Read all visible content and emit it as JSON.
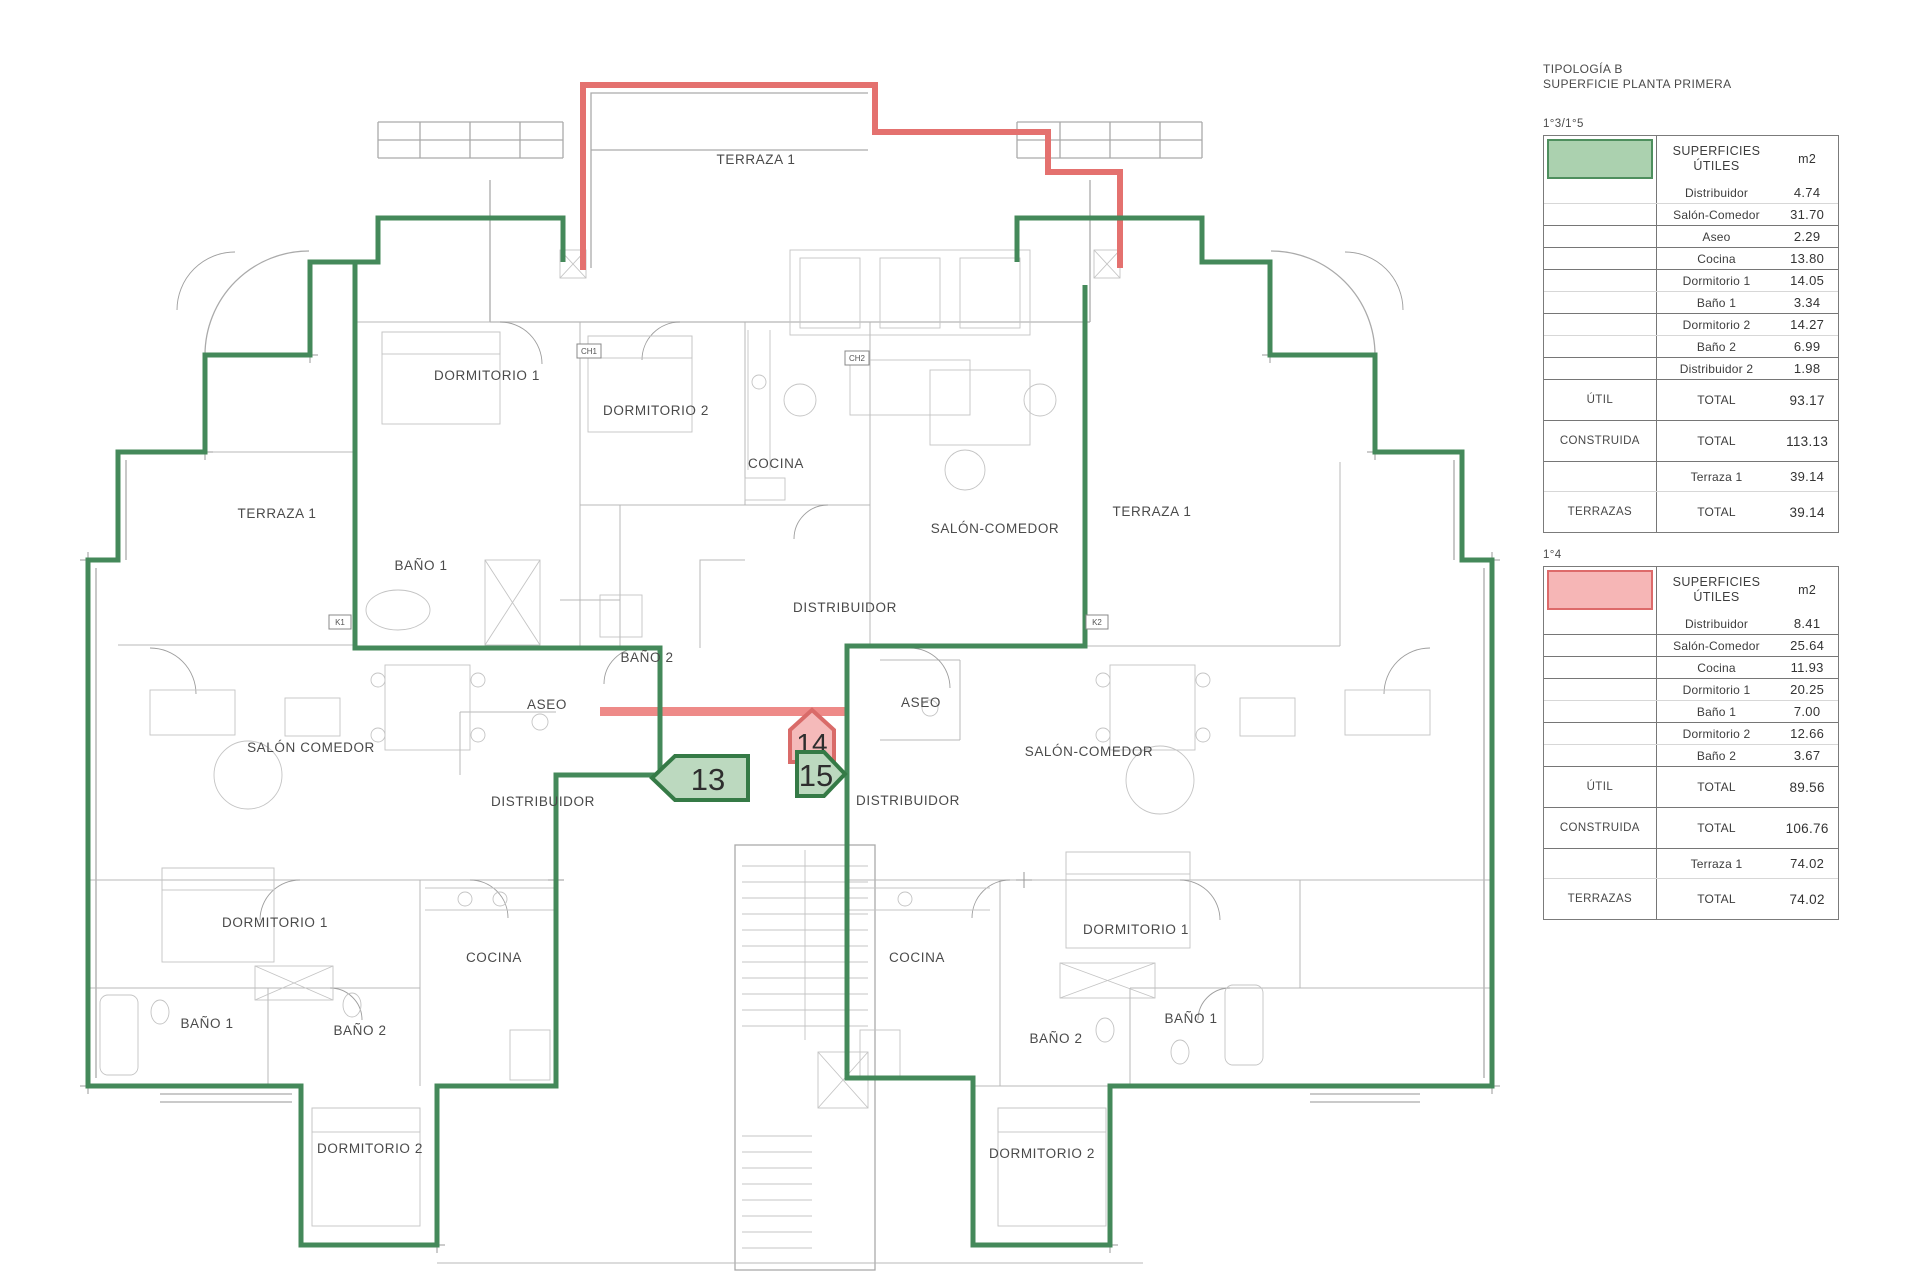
{
  "panel": {
    "title_line1": "TIPOLOGÍA B",
    "title_line2": "SUPERFICIE PLANTA PRIMERA",
    "colors": {
      "unit_13_15_fill": "#abd1af",
      "unit_13_15_border": "#4e8f5e",
      "unit_14_fill": "#f6b6b6",
      "unit_14_border": "#dd6a6a"
    },
    "tables": [
      {
        "unit_label": "1°3/1°5",
        "swatch": "green",
        "header": {
          "title": "SUPERFICIES ÚTILES",
          "unit": "m2"
        },
        "rows": [
          {
            "cat": "",
            "name": "Distribuidor",
            "value": "4.74"
          },
          {
            "cat": "",
            "name": "Salón-Comedor",
            "value": "31.70"
          },
          {
            "cat": "",
            "name": "Aseo",
            "value": "2.29"
          },
          {
            "cat": "",
            "name": "Cocina",
            "value": "13.80"
          },
          {
            "cat": "",
            "name": "Dormitorio 1",
            "value": "14.05"
          },
          {
            "cat": "",
            "name": "Baño 1",
            "value": "3.34"
          },
          {
            "cat": "",
            "name": "Dormitorio 2",
            "value": "14.27"
          },
          {
            "cat": "",
            "name": "Baño 2",
            "value": "6.99"
          },
          {
            "cat": "",
            "name": "Distribuidor 2",
            "value": "1.98"
          },
          {
            "cat": "ÚTIL",
            "name": "TOTAL",
            "value": "93.17"
          },
          {
            "cat": "CONSTRUIDA",
            "name": "TOTAL",
            "value": "113.13"
          },
          {
            "cat": "",
            "name": "Terraza 1",
            "value": "39.14"
          },
          {
            "cat": "TERRAZAS",
            "name": "TOTAL",
            "value": "39.14"
          }
        ]
      },
      {
        "unit_label": "1°4",
        "swatch": "pink",
        "header": {
          "title": "SUPERFICIES ÚTILES",
          "unit": "m2"
        },
        "rows": [
          {
            "cat": "",
            "name": "Distribuidor",
            "value": "8.41"
          },
          {
            "cat": "",
            "name": "Salón-Comedor",
            "value": "25.64"
          },
          {
            "cat": "",
            "name": "Cocina",
            "value": "11.93"
          },
          {
            "cat": "",
            "name": "Dormitorio 1",
            "value": "20.25"
          },
          {
            "cat": "",
            "name": "Baño 1",
            "value": "7.00"
          },
          {
            "cat": "",
            "name": "Dormitorio 2",
            "value": "12.66"
          },
          {
            "cat": "",
            "name": "Baño 2",
            "value": "3.67"
          },
          {
            "cat": "ÚTIL",
            "name": "TOTAL",
            "value": "89.56"
          },
          {
            "cat": "CONSTRUIDA",
            "name": "TOTAL",
            "value": "106.76"
          },
          {
            "cat": "",
            "name": "Terraza 1",
            "value": "74.02"
          },
          {
            "cat": "TERRAZAS",
            "name": "TOTAL",
            "value": "74.02"
          }
        ]
      }
    ]
  },
  "plan": {
    "labels": [
      "TERRAZA 1",
      "DORMITORIO 1",
      "DORMITORIO 2",
      "COCINA",
      "SALÓN-COMEDOR",
      "TERRAZA 1",
      "BAÑO 1",
      "DISTRIBUIDOR",
      "BAÑO 2",
      "ASEO",
      "ASEO",
      "SALÓN COMEDOR",
      "DISTRIBUIDOR",
      "DISTRIBUIDOR",
      "SALÓN-COMEDOR",
      "TERRAZA 1",
      "DORMITORIO 1",
      "COCINA",
      "COCINA",
      "DORMITORIO 1",
      "BAÑO 1",
      "BAÑO 2",
      "BAÑO 2",
      "BAÑO 1",
      "DORMITORIO 2",
      "DORMITORIO 2"
    ],
    "badges": [
      "13",
      "14",
      "15"
    ],
    "markers": [
      "K1",
      "K2",
      "CH1",
      "CH2"
    ]
  }
}
